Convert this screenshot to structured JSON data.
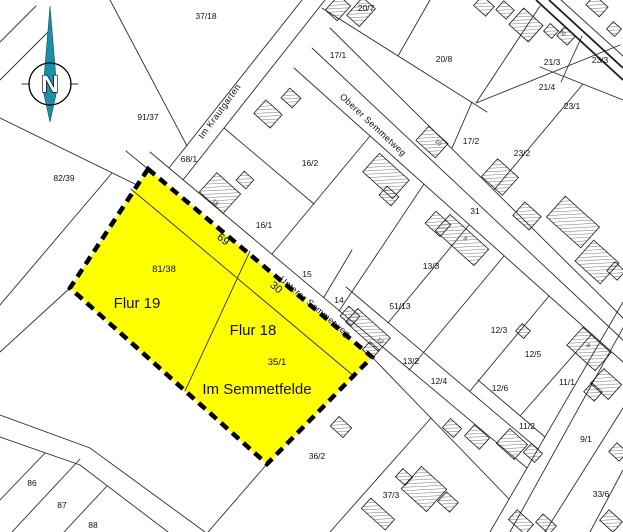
{
  "map": {
    "colors": {
      "highlight": "#ffff00",
      "compass": "#1d8ea8",
      "line": "#2e2e2e",
      "dash": "#000000"
    },
    "compass": {
      "label": "N"
    },
    "streets": [
      {
        "id": "im-krautgarten",
        "name": "Im Krautgarten",
        "x": 222,
        "y": 113,
        "rotation": -54
      },
      {
        "id": "oberer-semmetweg",
        "name": "Oberer Semmetweg",
        "x": 371,
        "y": 127,
        "rotation": 43
      },
      {
        "id": "unterer-semmetweg",
        "name": "Unterer Semmetweg",
        "x": 313,
        "y": 309,
        "rotation": 40
      }
    ],
    "highlight_labels": [
      {
        "id": "flur-19",
        "text": "Flur 19",
        "x": 137,
        "y": 308
      },
      {
        "id": "flur-18",
        "text": "Flur 18",
        "x": 253,
        "y": 335
      },
      {
        "id": "im-semmetfelde",
        "text": "Im Semmetfelde",
        "x": 257,
        "y": 394
      }
    ],
    "parcel_labels": [
      {
        "text": "37/18",
        "x": 206,
        "y": 19
      },
      {
        "text": "20/7",
        "x": 366,
        "y": 11
      },
      {
        "text": "17/1",
        "x": 338,
        "y": 58
      },
      {
        "text": "20/8",
        "x": 444,
        "y": 62
      },
      {
        "text": "21/3",
        "x": 552,
        "y": 65
      },
      {
        "text": "23/3",
        "x": 600,
        "y": 63
      },
      {
        "text": "21/4",
        "x": 547,
        "y": 90
      },
      {
        "text": "23/1",
        "x": 572,
        "y": 109
      },
      {
        "text": "91/37",
        "x": 148,
        "y": 120
      },
      {
        "text": "17/2",
        "x": 471,
        "y": 144
      },
      {
        "text": "23/2",
        "x": 522,
        "y": 156
      },
      {
        "text": "68/1",
        "x": 189,
        "y": 162
      },
      {
        "text": "16/2",
        "x": 310,
        "y": 166
      },
      {
        "text": "82/39",
        "x": 64,
        "y": 181
      },
      {
        "text": "31",
        "x": 475,
        "y": 214
      },
      {
        "text": "16/1",
        "x": 264,
        "y": 228
      },
      {
        "text": "69",
        "x": 221,
        "y": 242,
        "rot": 40,
        "size": 11
      },
      {
        "text": "13/3",
        "x": 431,
        "y": 269
      },
      {
        "text": "81/38",
        "x": 164,
        "y": 272,
        "size": 9.5
      },
      {
        "text": "15",
        "x": 307,
        "y": 277
      },
      {
        "text": "30",
        "x": 274,
        "y": 290,
        "rot": 40,
        "size": 11
      },
      {
        "text": "14",
        "x": 339,
        "y": 303
      },
      {
        "text": "51/13",
        "x": 400,
        "y": 309
      },
      {
        "text": "12/3",
        "x": 499,
        "y": 333
      },
      {
        "text": "12/5",
        "x": 533,
        "y": 357
      },
      {
        "text": "13/2",
        "x": 411,
        "y": 364
      },
      {
        "text": "35/1",
        "x": 277,
        "y": 365,
        "size": 9.5
      },
      {
        "text": "12/4",
        "x": 439,
        "y": 384
      },
      {
        "text": "11/1",
        "x": 567,
        "y": 385
      },
      {
        "text": "12/6",
        "x": 500,
        "y": 391
      },
      {
        "text": "11/2",
        "x": 527,
        "y": 429
      },
      {
        "text": "9/1",
        "x": 586,
        "y": 442
      },
      {
        "text": "36/2",
        "x": 317,
        "y": 459
      },
      {
        "text": "86",
        "x": 32,
        "y": 486
      },
      {
        "text": "33/6",
        "x": 601,
        "y": 497
      },
      {
        "text": "37/3",
        "x": 391,
        "y": 498
      },
      {
        "text": "87",
        "x": 62,
        "y": 508
      },
      {
        "text": "88",
        "x": 93,
        "y": 528
      }
    ],
    "house_numbers": [
      {
        "text": "18",
        "x": 214,
        "y": 204,
        "rot": 42
      },
      {
        "text": "10",
        "x": 437,
        "y": 144,
        "rot": 42
      },
      {
        "text": "9",
        "x": 464,
        "y": 240,
        "rot": 42
      },
      {
        "text": "20",
        "x": 561,
        "y": 34,
        "rot": 42
      },
      {
        "text": "12",
        "x": 379,
        "y": 342,
        "rot": 42
      },
      {
        "text": "9",
        "x": 587,
        "y": 347,
        "rot": 42
      }
    ]
  }
}
